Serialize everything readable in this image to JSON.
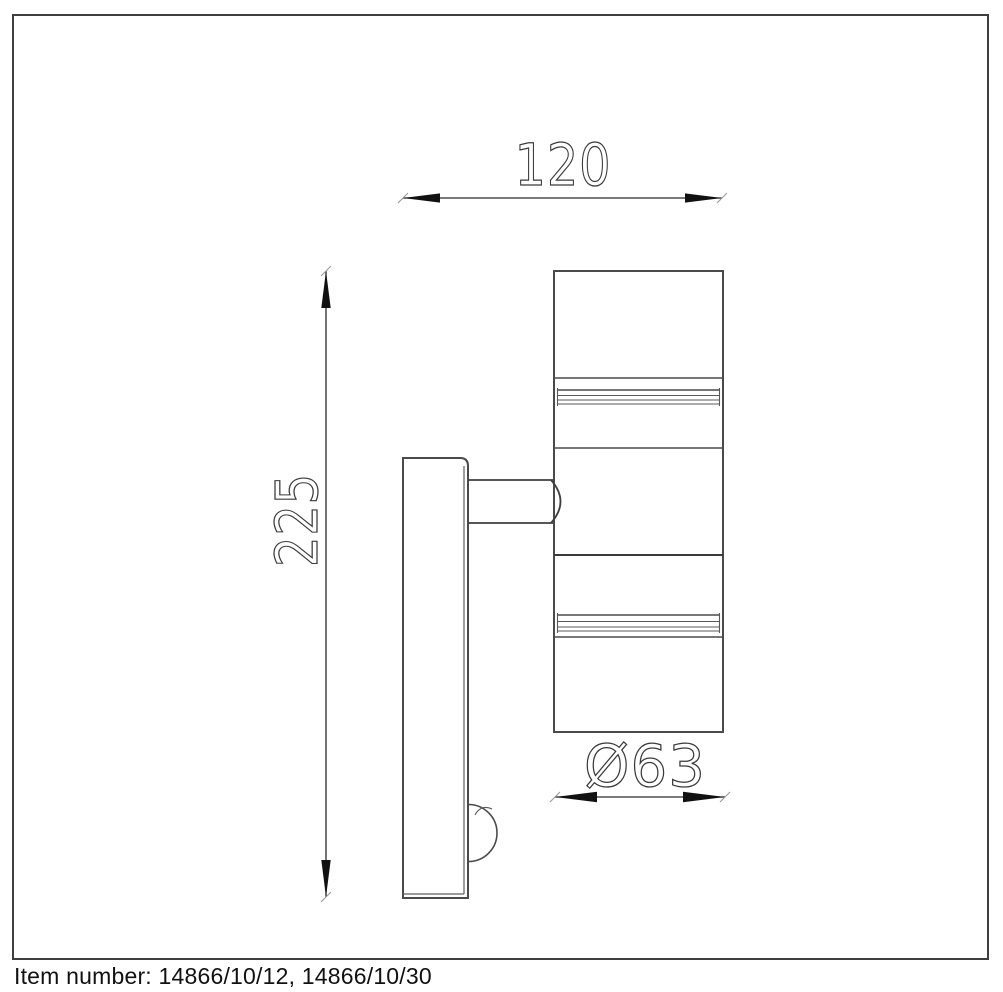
{
  "page": {
    "background": "#ffffff"
  },
  "frame": {
    "border_color": "#3f3f3f"
  },
  "drawing": {
    "subject": "wall-mounted-up-down-spotlight-with-sensor-side-view",
    "body_line_color": "#4a4a4a",
    "dimension_line_color": "#2b2b2b",
    "dimension_text_color": "#3a3a3a"
  },
  "dimensions": {
    "width": {
      "label": "120"
    },
    "height": {
      "label": "225"
    },
    "diameter": {
      "label": "Ø63"
    }
  },
  "footer": {
    "item_number": "Item number: 14866/10/12, 14866/10/30"
  }
}
